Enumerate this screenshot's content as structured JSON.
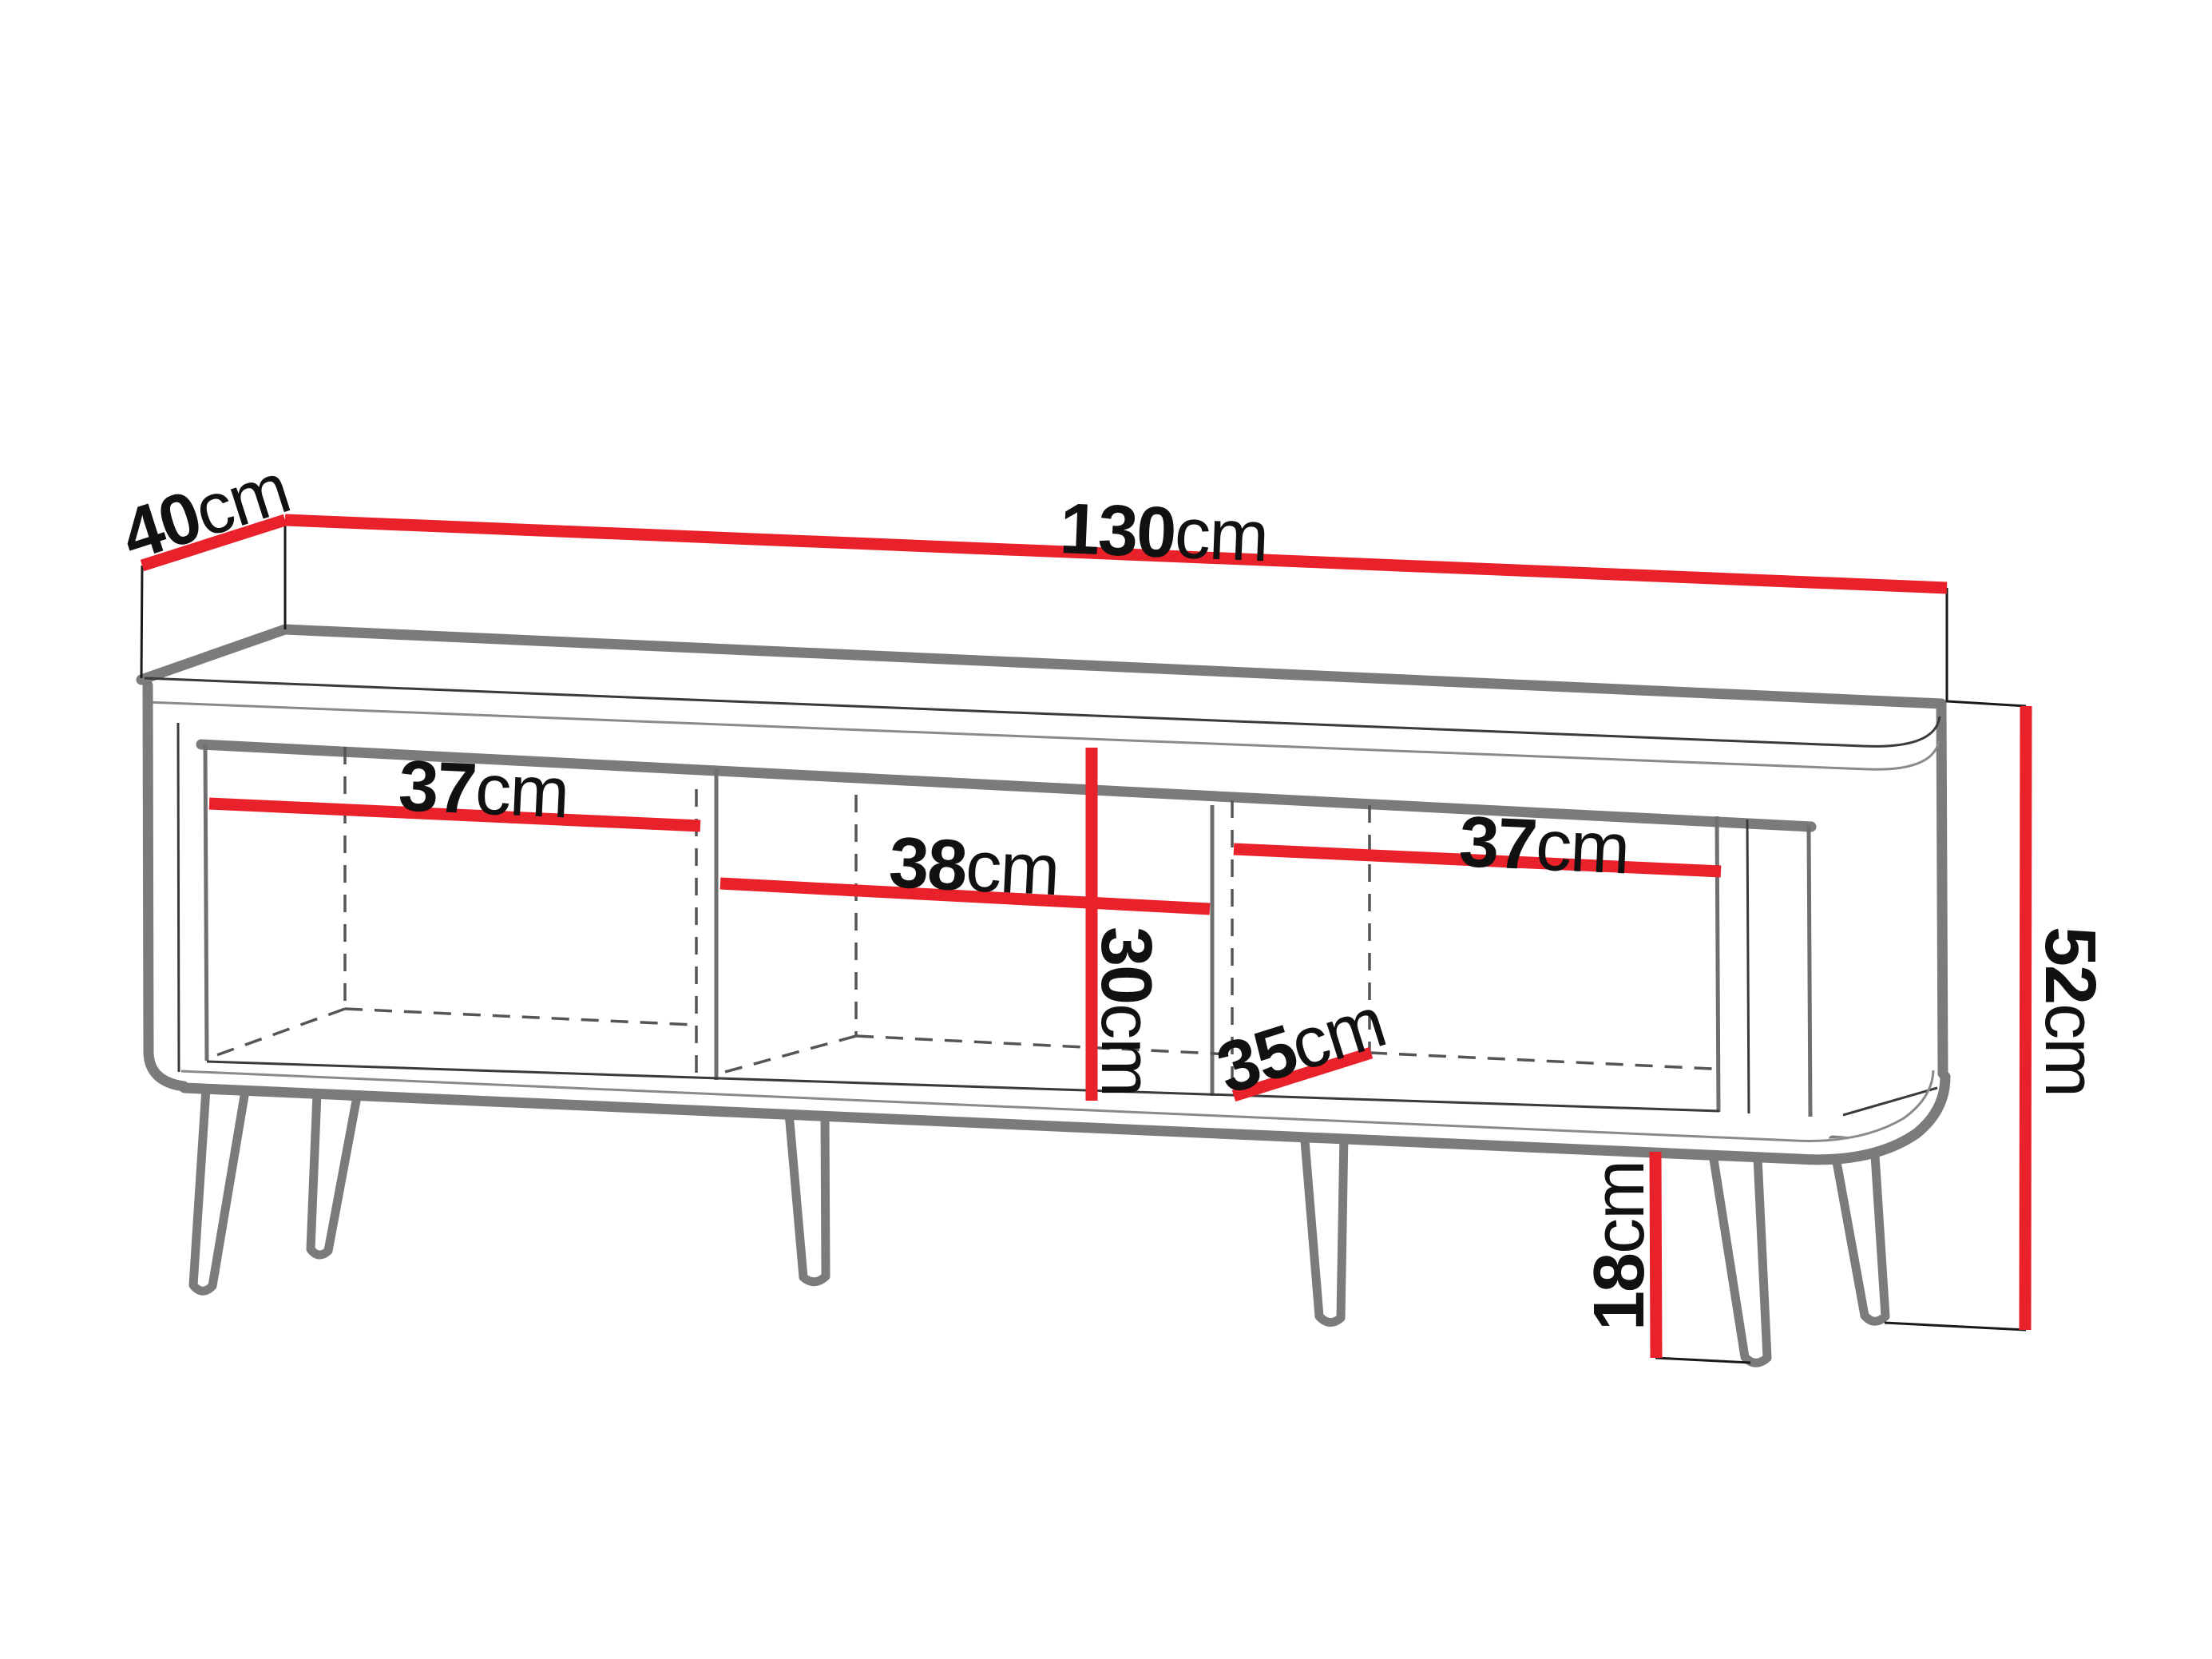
{
  "diagram": {
    "type": "furniture-dimension-drawing",
    "subject": "TV stand / sideboard with three open compartments and six tapered legs",
    "colors": {
      "dimension_line": "#e8212b",
      "outline_gray": "#7b7b7b",
      "label_text": "#111111",
      "background": "#ffffff"
    }
  },
  "dims": {
    "depth": {
      "value": "40",
      "unit": "cm"
    },
    "width": {
      "value": "130",
      "unit": "cm"
    },
    "height": {
      "value": "52",
      "unit": "cm"
    },
    "leg_height": {
      "value": "18",
      "unit": "cm"
    },
    "left_compartment_width": {
      "value": "37",
      "unit": "cm"
    },
    "middle_compartment_width": {
      "value": "38",
      "unit": "cm"
    },
    "right_compartment_width": {
      "value": "37",
      "unit": "cm"
    },
    "compartment_height": {
      "value": "30",
      "unit": "cm"
    },
    "compartment_depth": {
      "value": "35",
      "unit": "cm"
    }
  }
}
